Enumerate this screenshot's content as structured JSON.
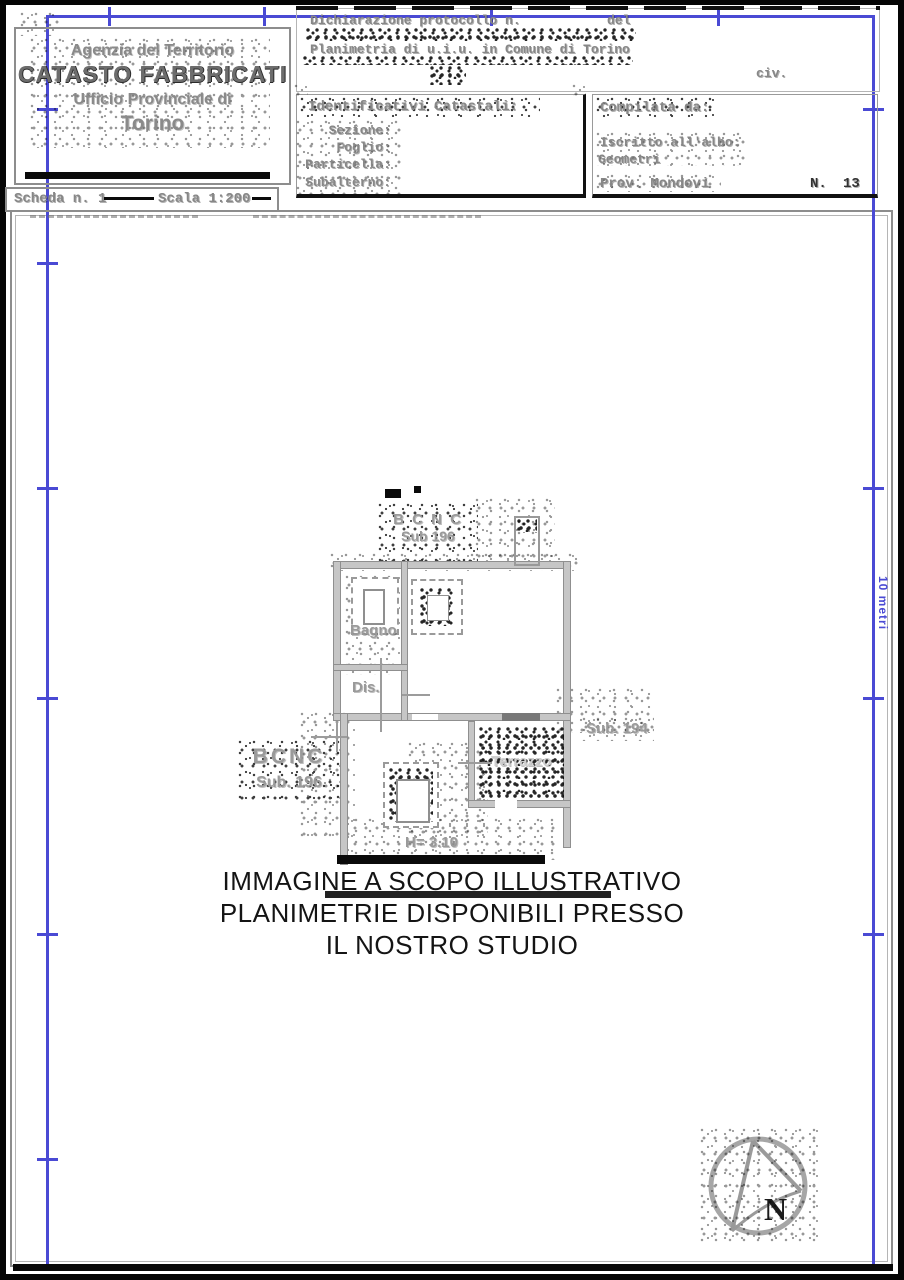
{
  "header_left": {
    "agency": "Agenzia del Territorio",
    "registry": "CATASTO FABBRICATI",
    "office": "Ufficio Provinciale di",
    "city": "Torino"
  },
  "scheda_bar": {
    "scheda": "Scheda n. 1",
    "scala": "Scala 1:200"
  },
  "declaration": {
    "protocol": "Dichiarazione protocollo n.",
    "del": "del",
    "planimetria": "Planimetria di u.i.u. in Comune di Torino",
    "civ": "civ."
  },
  "identificativi": {
    "title": "Identificativi Catastali:",
    "sezione": "Sezione:",
    "foglio": "Foglio:",
    "particella": "Particella:",
    "subalterno": "Subalterno:"
  },
  "compilata": {
    "title": "Compilata da:",
    "albo": "Iscritto all'albo:",
    "albo_value": "Geometri",
    "prov": "Prov. Mondovi",
    "n_label": "N.",
    "n_value": "13"
  },
  "plan": {
    "bcnc_top_line1": "B C N C",
    "bcnc_top_line2": "Sub 196",
    "bcnc_left_line1": "BCNC",
    "bcnc_left_line2": "Sub. 196",
    "bagno": "Bagno",
    "dis": "Dis.",
    "terrazzo": "Terrazzo",
    "sub_194": "Sub. 194",
    "height": "H= 3.10"
  },
  "watermark": {
    "line1": "IMMAGINE A SCOPO ILLUSTRATIVO",
    "line2": "PLANIMETRIE DISPONIBILI PRESSO",
    "line3": "IL NOSTRO STUDIO"
  },
  "ruler": {
    "label": "10 metri"
  },
  "compass": {
    "label": "N"
  },
  "colors": {
    "ruler_blue": "#4a4ad4",
    "wall_gray": "#c6c6c6",
    "faded_text_gray": "#8a8a8a"
  }
}
